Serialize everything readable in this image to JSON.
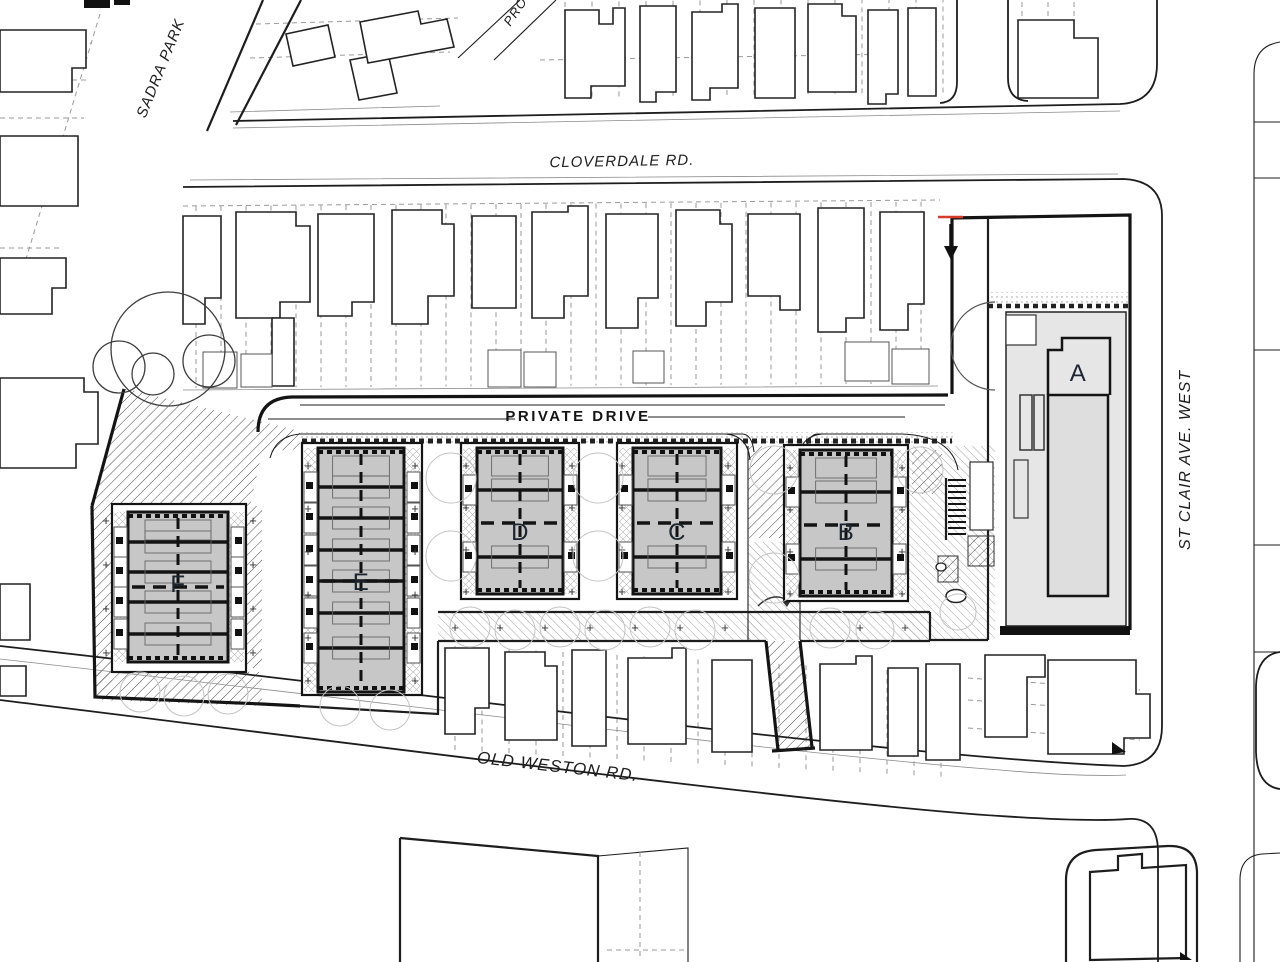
{
  "drawing": {
    "streets": {
      "sadra_park": "SADRA PARK",
      "prospect_partial": "PRO",
      "cloverdale": "CLOVERDALE RD.",
      "private_drive": "PRIVATE DRIVE",
      "st_clair": "ST CLAIR AVE. WEST",
      "old_weston": "OLD WESTON RD."
    },
    "blocks": {
      "a": "A",
      "b": "B",
      "c": "C",
      "d": "D",
      "e": "E",
      "f": "F"
    },
    "symbols": {
      "plus_marker": "+"
    },
    "colors": {
      "line": "#1d1d1d",
      "unit_fill": "#c7c7c7",
      "building_a_fill": "#e6e6e6",
      "accent_red": "#d63a2a",
      "lot_line": "#9a9a9a",
      "paper": "#ffffff"
    }
  }
}
